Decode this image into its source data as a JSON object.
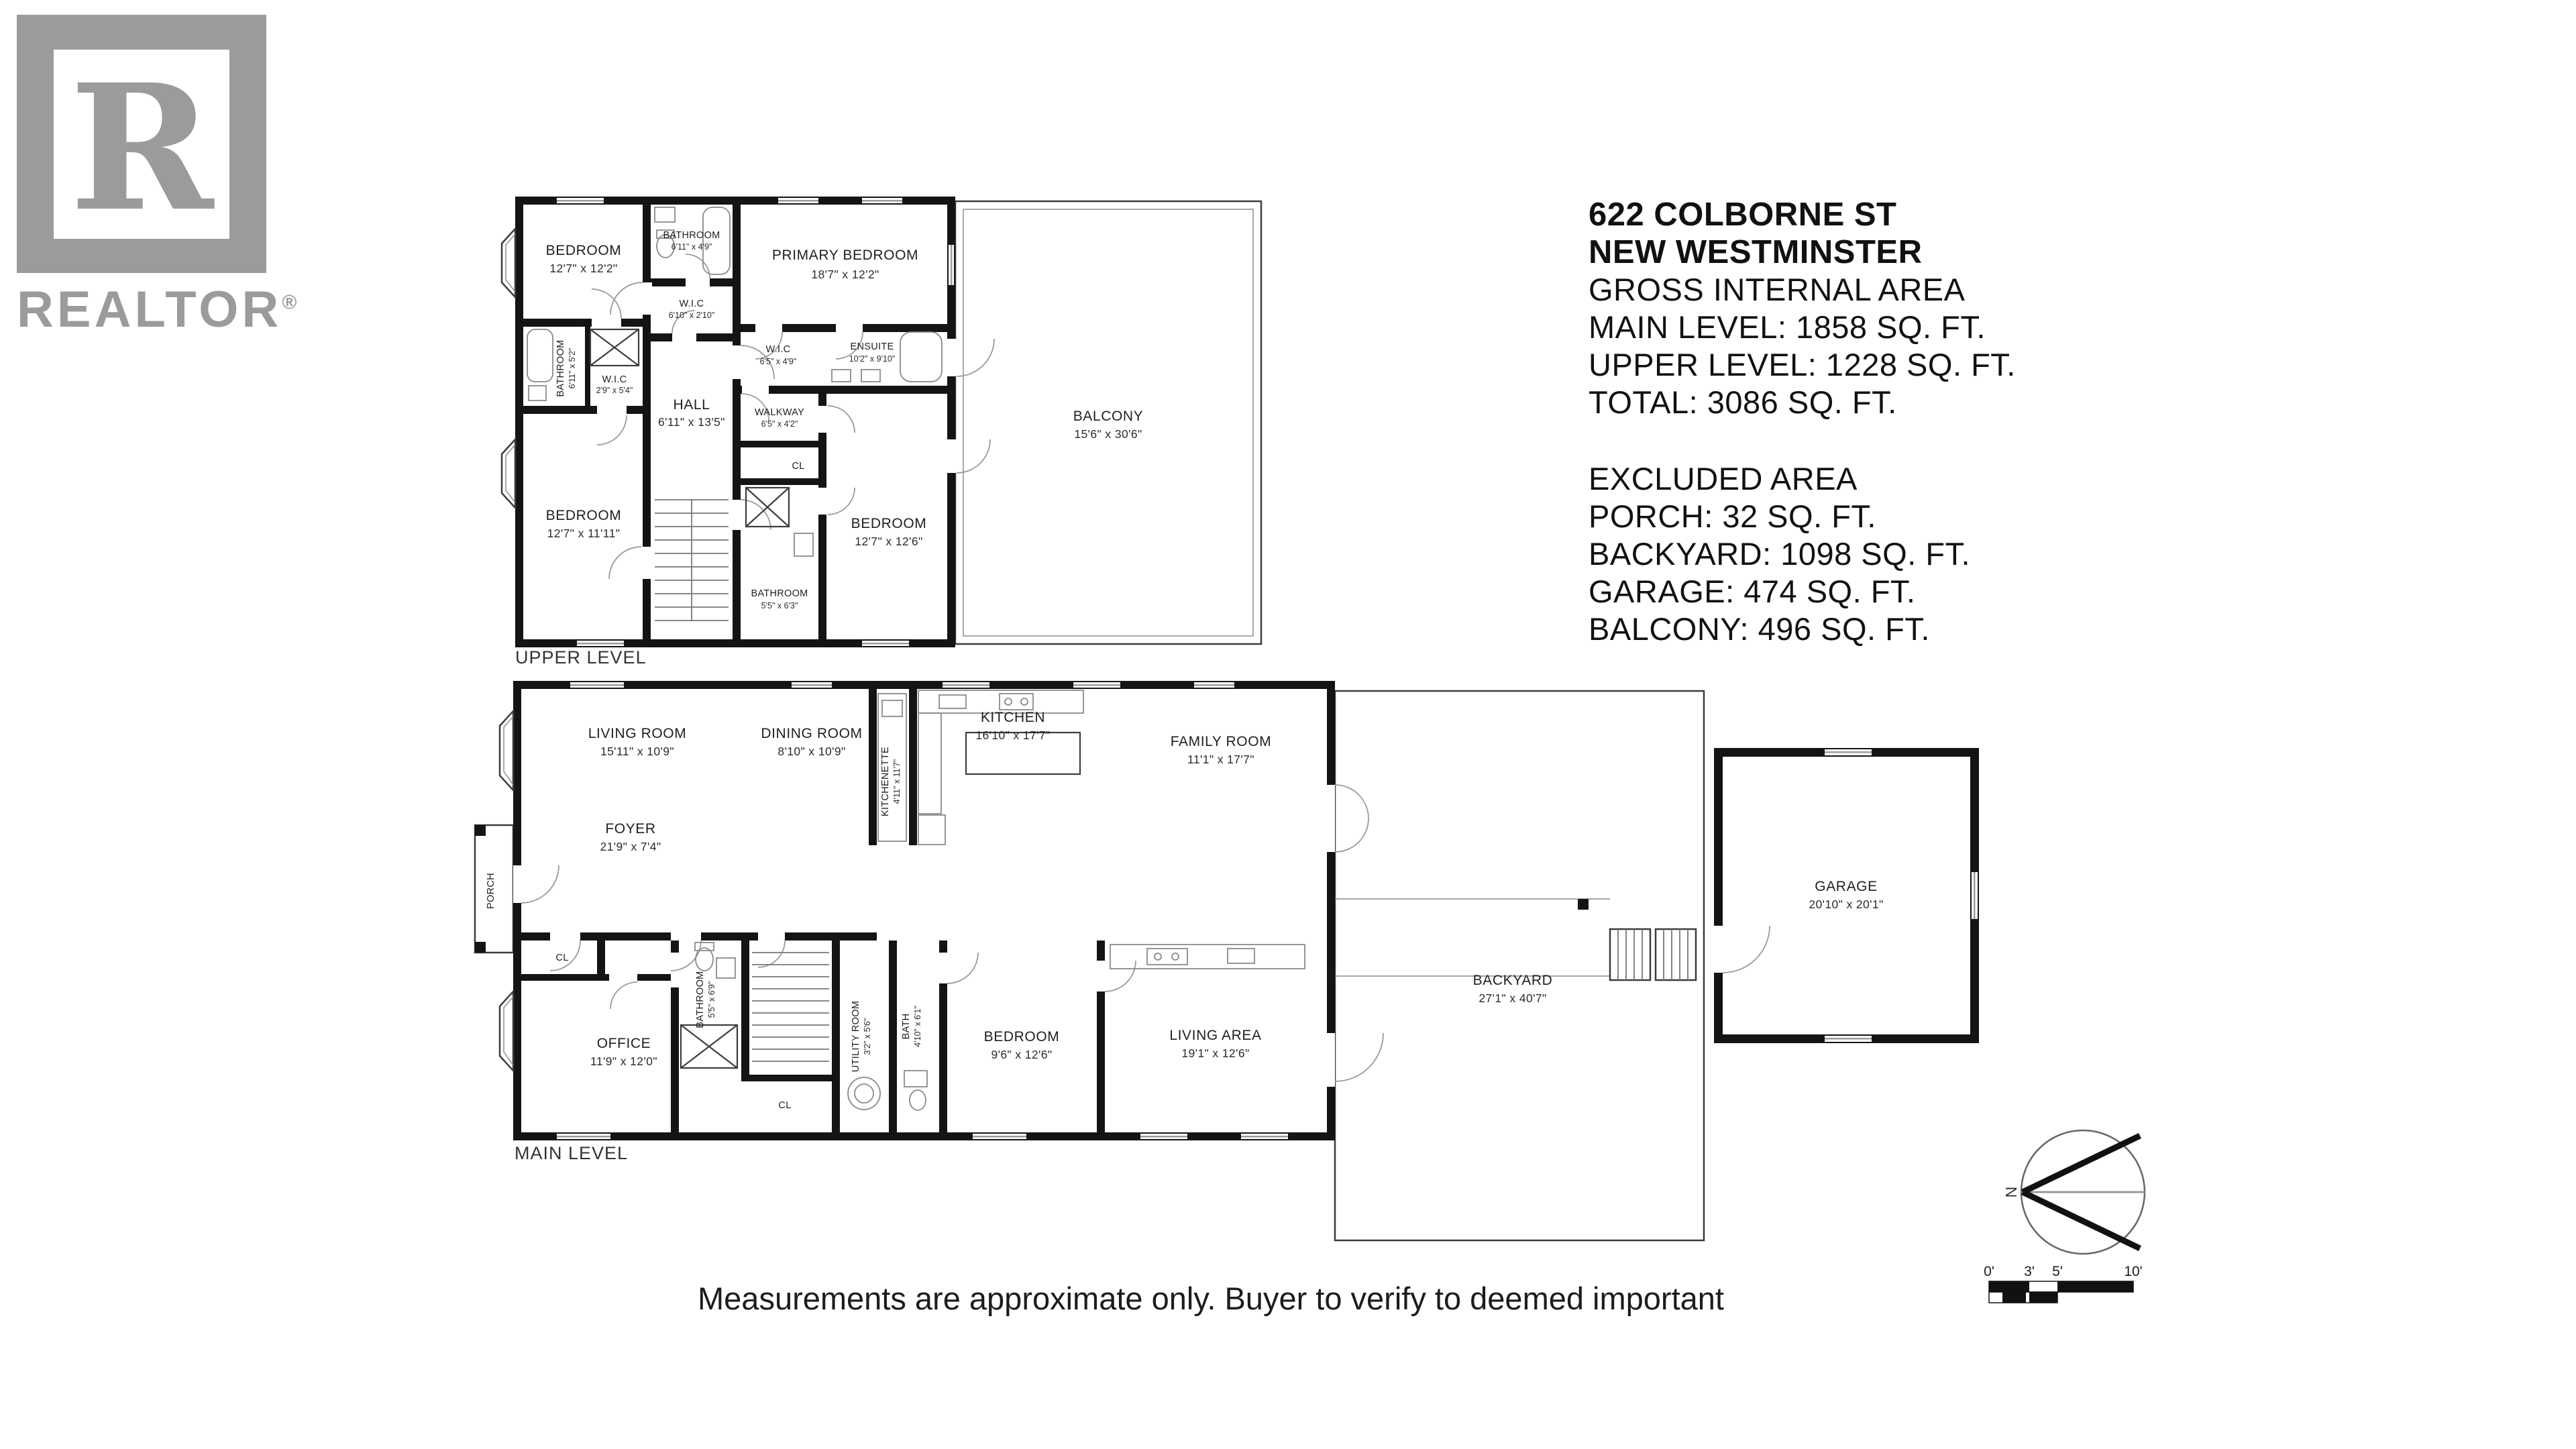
{
  "branding": {
    "logo_letter": "R",
    "logo_text": "REALTOR",
    "registered": "®"
  },
  "info": {
    "address1": "622 COLBORNE ST",
    "address2": "NEW WESTMINSTER",
    "gross_title": "GROSS INTERNAL AREA",
    "main_level": "MAIN LEVEL: 1858 SQ. FT.",
    "upper_level": "UPPER LEVEL: 1228 SQ. FT.",
    "total": "TOTAL: 3086 SQ. FT.",
    "excluded_title": "EXCLUDED AREA",
    "porch": "PORCH: 32 SQ. FT.",
    "backyard": "BACKYARD: 1098 SQ. FT.",
    "garage": "GARAGE: 474 SQ. FT.",
    "balcony": "BALCONY: 496 SQ. FT."
  },
  "upper": {
    "caption": "UPPER LEVEL",
    "rooms": {
      "bedroom_tl": {
        "name": "BEDROOM",
        "dims": "12'7\" x 12'2\""
      },
      "bathroom_top": {
        "name": "BATHROOM",
        "dims": "6'11\" x 4'9\""
      },
      "wic_top": {
        "name": "W.I.C",
        "dims": "6'10\" x 2'10\""
      },
      "primary": {
        "name": "PRIMARY BEDROOM",
        "dims": "18'7\" x 12'2\""
      },
      "hall": {
        "name": "HALL",
        "dims": "6'11\" x 13'5\""
      },
      "bathroom_left": {
        "name": "BATHROOM",
        "dims": "6'11\" x 5'2\""
      },
      "wic_mid": {
        "name": "W.I.C",
        "dims": "2'9\" x 5'4\""
      },
      "wic_right": {
        "name": "W.I.C",
        "dims": "6'5\" x 4'9\""
      },
      "ensuite": {
        "name": "ENSUITE",
        "dims": "10'2\" x 9'10\""
      },
      "walkway": {
        "name": "WALKWAY",
        "dims": "6'5\" x 4'2\""
      },
      "closet": {
        "name": "CL"
      },
      "bathroom_br": {
        "name": "BATHROOM",
        "dims": "5'5\" x 6'3\""
      },
      "bedroom_bl": {
        "name": "BEDROOM",
        "dims": "12'7\" x 11'11\""
      },
      "bedroom_bm": {
        "name": "BEDROOM",
        "dims": "12'7\" x 12'6\""
      },
      "balcony": {
        "name": "BALCONY",
        "dims": "15'6\" x 30'6\""
      }
    }
  },
  "main": {
    "caption": "MAIN LEVEL",
    "rooms": {
      "living_room": {
        "name": "LIVING ROOM",
        "dims": "15'11\" x 10'9\""
      },
      "dining_room": {
        "name": "DINING ROOM",
        "dims": "8'10\" x 10'9\""
      },
      "kitchenette": {
        "name": "KITCHENETTE",
        "dims": "4'11\" x 11'7\""
      },
      "kitchen": {
        "name": "KITCHEN",
        "dims": "16'10\" x 17'7\""
      },
      "family_room": {
        "name": "FAMILY ROOM",
        "dims": "11'1\" x 17'7\""
      },
      "foyer": {
        "name": "FOYER",
        "dims": "21'9\" x 7'4\""
      },
      "porch": {
        "name": "PORCH"
      },
      "closet_a": {
        "name": "CL"
      },
      "closet_b": {
        "name": "CL"
      },
      "office": {
        "name": "OFFICE",
        "dims": "11'9\" x 12'0\""
      },
      "bathroom": {
        "name": "BATHROOM",
        "dims": "5'5\" x 6'9\""
      },
      "utility": {
        "name": "UTILITY ROOM",
        "dims": "3'2\" x 5'6\""
      },
      "bath": {
        "name": "BATH",
        "dims": "4'10\" x 6'1\""
      },
      "bedroom": {
        "name": "BEDROOM",
        "dims": "9'6\" x 12'6\""
      },
      "living_area": {
        "name": "LIVING AREA",
        "dims": "19'1\" x 12'6\""
      },
      "backyard": {
        "name": "BACKYARD",
        "dims": "27'1\" x 40'7\""
      },
      "garage": {
        "name": "GARAGE",
        "dims": "20'10\" x 20'1\""
      }
    }
  },
  "compass": {
    "north": "N"
  },
  "scale_bar": {
    "t0": "0'",
    "t1": "3'",
    "t2": "5'",
    "t3": "10'"
  },
  "footer": {
    "disclaimer": "Measurements are approximate only. Buyer to verify to deemed important"
  }
}
